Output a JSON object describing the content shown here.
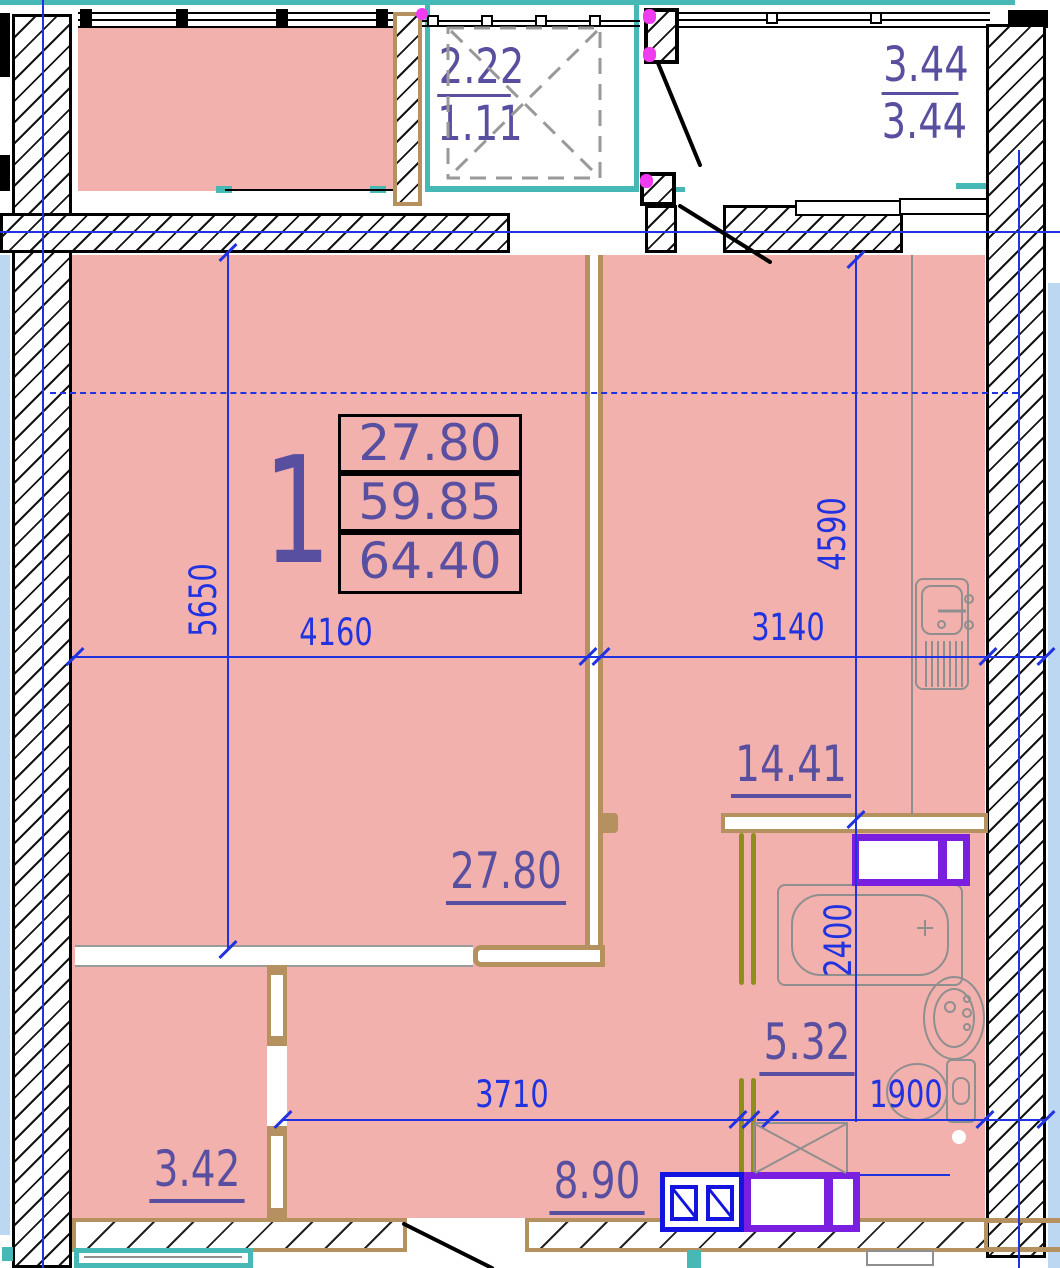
{
  "title": "Apartment floor plan - one-room unit",
  "unit": {
    "number": "1"
  },
  "summary_table": {
    "living_area": "27.80",
    "apartment_area": "59.85",
    "total_area": "64.40"
  },
  "rooms": {
    "living": "27.80",
    "kitchen": "14.41",
    "bathroom": "5.32",
    "hall": "8.90",
    "wardrobe": "3.42",
    "balcony_left_top": "2.22",
    "balcony_left_bottom": "1.11",
    "balcony_right_top": "3.44",
    "balcony_right_bottom": "3.44"
  },
  "dims": {
    "5650": "5650",
    "4160": "4160",
    "3140": "3140",
    "4590": "4590",
    "2400": "2400",
    "3710": "3710",
    "1900": "1900"
  },
  "colors": {
    "room_fill": "#f3b1ad",
    "wall_line": "#000000",
    "partition_tan": "#b5915f",
    "glazing_teal": "#46b8b6",
    "hinge_magenta": "#ee3cee",
    "door_olive": "#8e8e1f",
    "dimension_blue": "#2133e0",
    "label_purple": "#584fa0",
    "appliance_purple": "#7a1fe0",
    "appliance_blue": "#1414e0",
    "adjacent_fill": "#bcd7f2",
    "fixture_gray": "#8f8f8f"
  }
}
